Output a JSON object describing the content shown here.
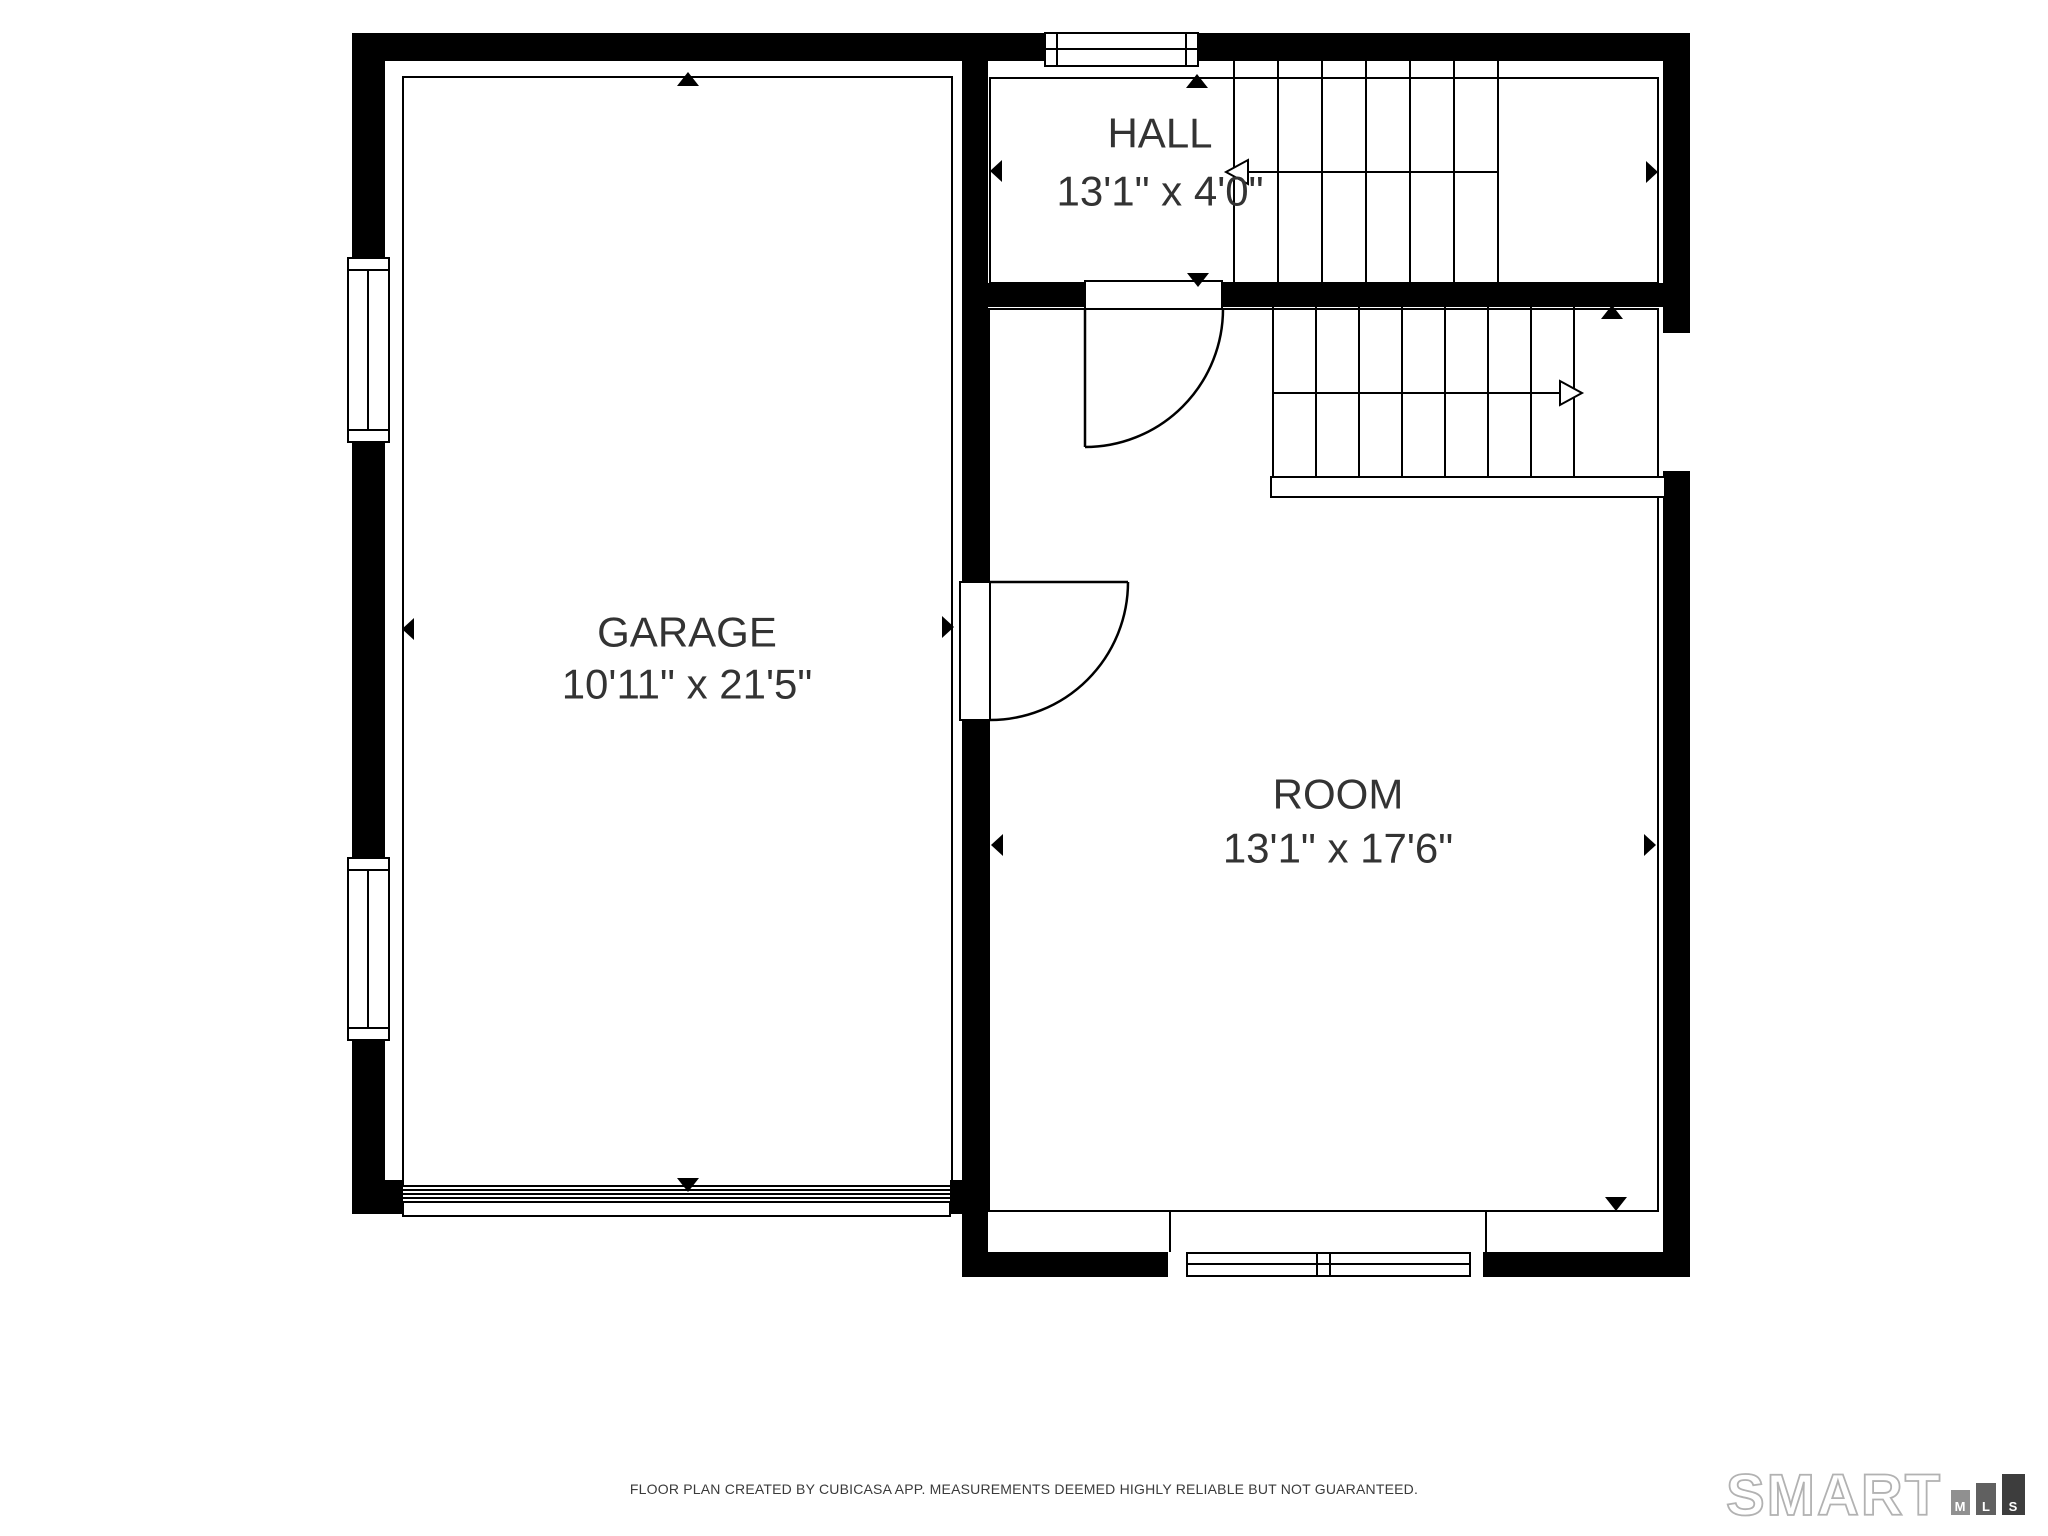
{
  "floor_plan": {
    "rooms": {
      "garage": {
        "name": "GARAGE",
        "dimensions": "10'11\" x 21'5\""
      },
      "hall": {
        "name": "HALL",
        "dimensions": "13'1\" x 4'0\""
      },
      "room": {
        "name": "ROOM",
        "dimensions": "13'1\" x 17'6\""
      }
    }
  },
  "footer": {
    "disclaimer": "FLOOR PLAN CREATED BY CUBICASA APP. MEASUREMENTS DEEMED HIGHLY RELIABLE BUT NOT GUARANTEED."
  },
  "logo": {
    "brand": "SMART",
    "bars": [
      {
        "label": "M"
      },
      {
        "label": "L"
      },
      {
        "label": "S"
      }
    ]
  },
  "colors": {
    "wall": "#000000",
    "room_text": "#333333",
    "disclaimer_text": "#3a3a3a",
    "logo_outline": "#b2b2b2",
    "logo_bar_m": "#909090",
    "logo_bar_l": "#606060",
    "logo_bar_s": "#3d3d3d"
  }
}
